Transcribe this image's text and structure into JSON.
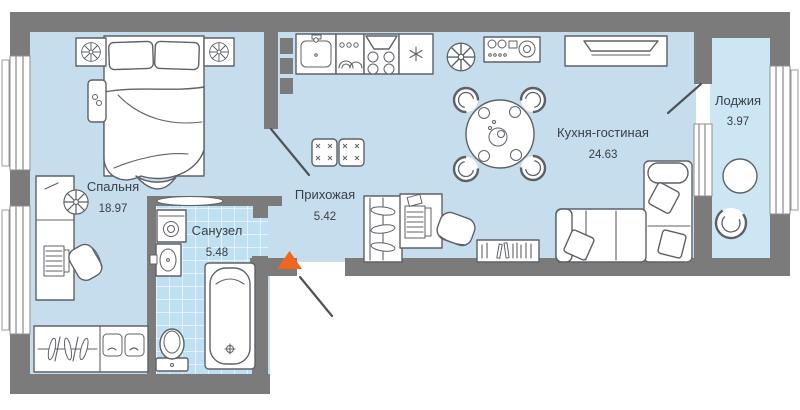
{
  "plan": {
    "colors": {
      "wall": "#7b7b7b",
      "room_fill": "#c6ddee",
      "loggia_fill": "#cde6f4",
      "tile_fill": "#bfdff2",
      "furniture_stroke": "#5d6166",
      "label_text": "#3b4045",
      "entrance_marker": "#f0661e"
    },
    "rooms": [
      {
        "id": "bedroom",
        "name": "Спальня",
        "area": "18.97"
      },
      {
        "id": "hallway",
        "name": "Прихожая",
        "area": "5.42"
      },
      {
        "id": "bathroom",
        "name": "Санузел",
        "area": "5.48"
      },
      {
        "id": "kitchen-living",
        "name": "Кухня-гостиная",
        "area": "24.63"
      },
      {
        "id": "loggia",
        "name": "Лоджия",
        "area": "3.97"
      }
    ],
    "furniture": [
      "double-bed",
      "pillow",
      "nightstand",
      "fan-plant",
      "bench",
      "desk",
      "laptop",
      "office-chair",
      "wardrobe",
      "washing-machine",
      "sink",
      "toilet",
      "bathtub",
      "pouf",
      "kitchen-sink",
      "cooktop",
      "extractor-hood",
      "fridge",
      "plant",
      "stereo",
      "tv",
      "dining-table",
      "dining-chair",
      "bookshelf",
      "sofa",
      "sofa-pillow",
      "loggia-table",
      "loggia-chair"
    ],
    "entrance_marker_shape": "triangle-up"
  }
}
